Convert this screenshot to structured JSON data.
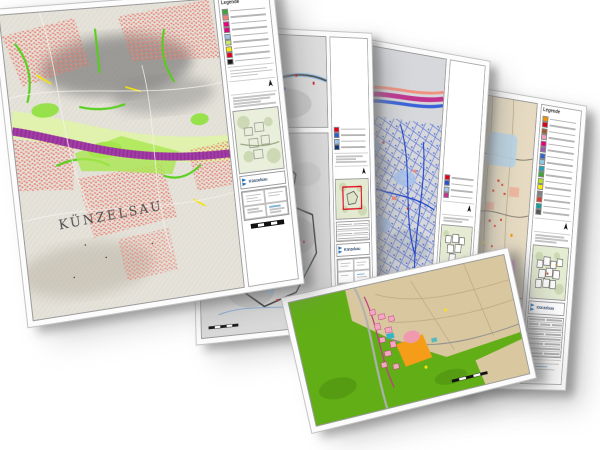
{
  "scene": {
    "background": "#ffffff"
  },
  "sheets": [
    {
      "kind": "color-city-plan",
      "map_label": "KÜNZELSAU",
      "logo_label": "Künzelsau",
      "legend_title": "Legende",
      "legend_colors": [
        "#3aa832",
        "#ef8276",
        "#e6007e",
        "#e6007e",
        "#9cc6ea",
        "#c5e86c",
        "#ffed00",
        "#e2001a",
        "#1a1a1a"
      ],
      "palette": {
        "base": "#e5e2da",
        "buildings": "#ef8276",
        "green_ways": "#54cf17",
        "pale_green_band": "#dff2ab",
        "river_band": "#a43ba8",
        "hillshade": "#606060"
      }
    },
    {
      "kind": "grayscale-survey-map",
      "logo_label": "Künzelsau",
      "legend_colors": [
        "#e2001a",
        "#2a5fd0",
        "#9cc6ea",
        "#10307a"
      ],
      "palette": {
        "base": "#dadada",
        "contour": "#3a3a3a",
        "water": "#9cc6ea",
        "marker_red": "#cc2222",
        "marker_blue": "#2a5fd0"
      },
      "overview_frame": "#e2001a"
    },
    {
      "kind": "blue-network-map",
      "logo_label": "Künzelsau",
      "legend_colors": [
        "#e2001a",
        "#2b50d4",
        "#a9c4ee",
        "#c0338f"
      ],
      "palette": {
        "base": "#d6d8dc",
        "network": "#2b50d4",
        "light_blue": "#a9c4ee",
        "magenta_ribbon": "#c0338f",
        "salmon": "#f2917e",
        "purple": "#8e4fae"
      }
    },
    {
      "kind": "zoning-plan",
      "legend_title": "Legende",
      "logo_label": "Künzelsau",
      "legend_colors": [
        "#f39200",
        "#e2001a",
        "#a05a2c",
        "#f0a0c0",
        "#e6007e",
        "#9b59b6",
        "#3366cc",
        "#8ecae6",
        "#22a3b4",
        "#3aa832",
        "#b5e61d",
        "#ffed00",
        "#808080",
        "#d9402a",
        "#11a0a0",
        "#555555"
      ],
      "palette": {
        "base": "#e6dbc2",
        "pink_zone": "#e3aed0",
        "purple_band": "#8e4fae",
        "teal_band": "#22a3b4",
        "red_buildings": "#d9402a",
        "blue_zone": "#b8d4e8"
      }
    },
    {
      "kind": "landuse-plan",
      "logo_label": "Künzelsau",
      "legend_colors": [
        "#61ae16",
        "#d9c89f",
        "#f2a7c3",
        "#f59d18",
        "#30b7c7"
      ],
      "palette": {
        "green": "#61ae16",
        "fields": "#d9c89f",
        "roads": "#b3b3b3",
        "settlement": "#f2a7c3",
        "orange_zone": "#f59d18",
        "teal": "#30b7c7",
        "magenta_road": "#c0398c"
      }
    }
  ]
}
